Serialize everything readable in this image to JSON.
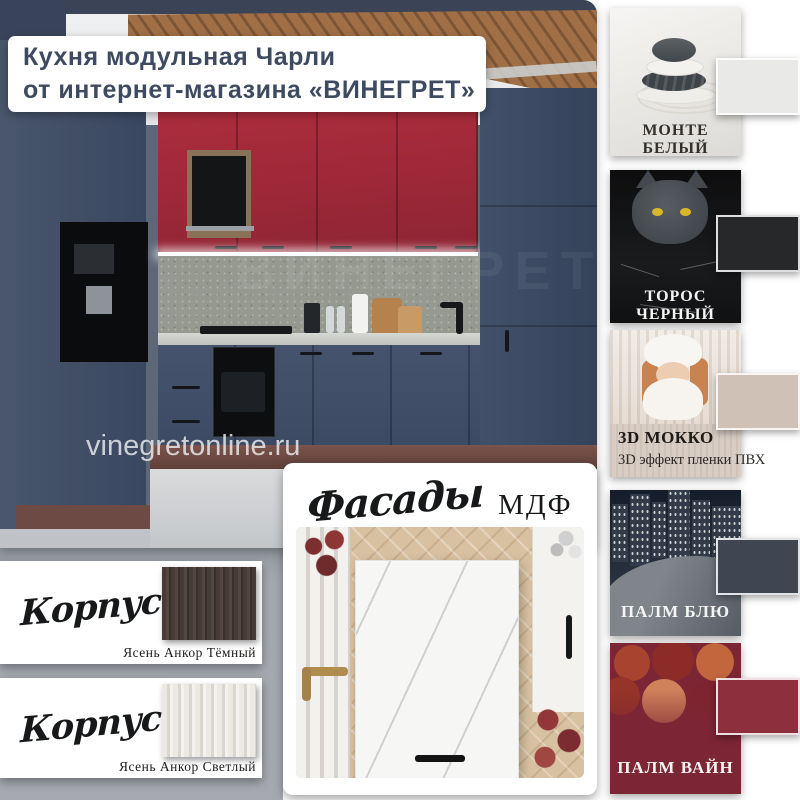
{
  "page": {
    "background": "#ffffff",
    "left_panel_background": "#a6aab0"
  },
  "header": {
    "title_line1": "Кухня модульная Чарли",
    "title_line2": "от интернет-магазина «ВИНЕГРЕТ»",
    "text_color": "#3d4a60"
  },
  "kitchen_photo": {
    "watermark": "vinegretonline.ru",
    "ghost_watermark": "ВИНЕГРЕТ",
    "cabinet_colors": {
      "upper": "#a02938",
      "base": "#44516a"
    }
  },
  "facade_finishes": [
    {
      "name": "МОНТЕ БЕЛЫЙ",
      "chip_color": "#e9e9e7",
      "photo": "zen-stones-on-white-sand"
    },
    {
      "name": "ТОРОС ЧЕРНЫЙ",
      "chip_color": "#26282a",
      "photo": "gray-cat-on-black-marble"
    },
    {
      "name": "3D МОККО",
      "subtitle": "3D эффект пленки ПВХ",
      "chip_color": "#cfc1b6",
      "photo": "woman-in-winter-white"
    },
    {
      "name": "ПАЛМ БЛЮ",
      "chip_color": "#3f4551",
      "photo": "night-city-skyline"
    },
    {
      "name": "ПАЛМ ВАЙН",
      "chip_color": "#8e2f3d",
      "photo": "wine-corks"
    }
  ],
  "carcass_cards": [
    {
      "script_word": "Корпус",
      "material": "ЛДСП",
      "finish_name": "Ясень Анкор Тёмный",
      "swatch": "dark-ash-wood"
    },
    {
      "script_word": "Корпус",
      "material": "ЛДСП",
      "finish_name": "Ясень Анкор Светлый",
      "swatch": "light-ash-wood"
    }
  ],
  "facade_card": {
    "script_word": "Фасады",
    "material": "МДФ",
    "photo": "white-marble-mdf-facade"
  }
}
